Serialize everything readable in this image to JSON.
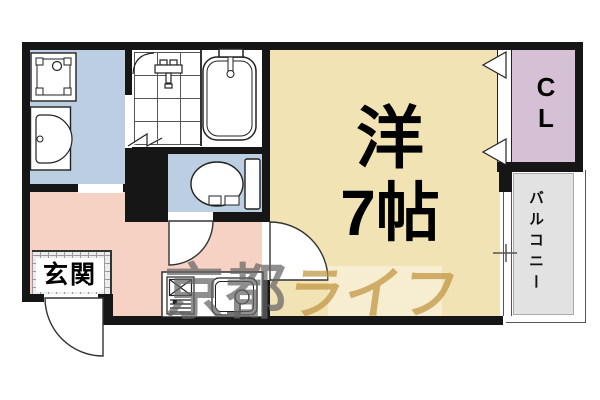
{
  "floorplan": {
    "type": "japanese-apartment-1K",
    "rooms": {
      "main_room": {
        "label_line1": "洋",
        "label_line2": "7帖"
      },
      "closet": {
        "label_line1": "C",
        "label_line2": "L"
      },
      "balcony": {
        "label": "バルコニー"
      },
      "entrance": {
        "label": "玄関"
      }
    },
    "watermark": {
      "left": "京都",
      "right": "ライフ"
    },
    "colors": {
      "wall": "#161616",
      "main_room_fill": "#F2E3B4",
      "wet_area_fill": "#BCCFE2",
      "hallway_fill": "#F6D2C4",
      "closet_fill": "#D6C0D6",
      "balcony_fill": "#E2E2E2",
      "watermark_gray": "#646464",
      "watermark_tan": "#BE913C"
    }
  }
}
